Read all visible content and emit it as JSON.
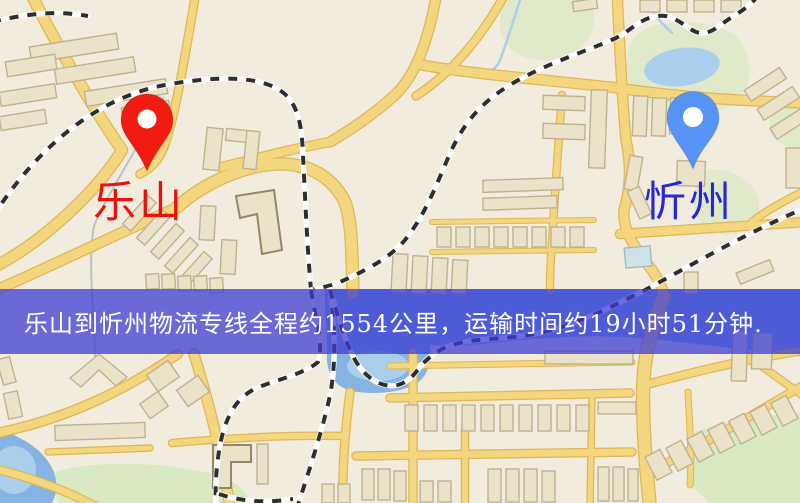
{
  "map": {
    "origin": {
      "label": "乐山",
      "pin_color": "#f21b12",
      "label_color": "#e81111"
    },
    "destination": {
      "label": "忻州",
      "pin_color": "#5793f5",
      "label_color": "#2626dd"
    },
    "banner": {
      "text": "乐山到忻州物流专线全程约1554公里，运输时间约19小时51分钟.",
      "distance_km": "1554",
      "duration": "19小时51分钟"
    },
    "colors": {
      "map_bg": "#f1ecde",
      "road": "#f4d67e",
      "road_casing": "#dfb658",
      "railway": "#2e2e2e",
      "water": "#85b4e3",
      "water_light": "#a9cfec",
      "park": "#d9e9c4",
      "building": "#eae2c9",
      "banner_bg": "rgba(59,59,210,0.74)",
      "banner_fg": "#ffffff"
    }
  }
}
